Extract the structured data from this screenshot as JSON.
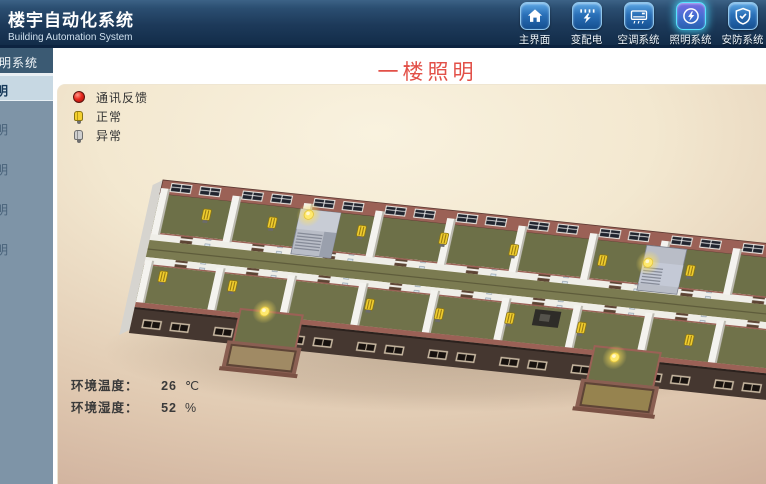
{
  "header": {
    "title": "楼宇自动化系统",
    "subtitle": "Building Automation System",
    "nav": [
      {
        "label": "主界面",
        "icon": "home-icon",
        "active": false
      },
      {
        "label": "变配电",
        "icon": "power-icon",
        "active": false
      },
      {
        "label": "空调系统",
        "icon": "hvac-icon",
        "active": false
      },
      {
        "label": "照明系统",
        "icon": "lighting-icon",
        "active": true
      },
      {
        "label": "安防系统",
        "icon": "shield-icon",
        "active": false
      }
    ]
  },
  "sidebar": {
    "header": "照明系统",
    "items": [
      {
        "label": "一楼照明",
        "active": true
      },
      {
        "label": "二楼照明",
        "active": false
      },
      {
        "label": "三楼照明",
        "active": false
      },
      {
        "label": "四楼照明",
        "active": false
      },
      {
        "label": "五楼照明",
        "active": false
      }
    ]
  },
  "page": {
    "title": "一楼照明"
  },
  "legend": [
    {
      "label": "通讯反馈",
      "icon": "comm-indicator"
    },
    {
      "label": "正常",
      "icon": "bulb-normal"
    },
    {
      "label": "异常",
      "icon": "bulb-abnormal"
    }
  ],
  "stats": [
    {
      "label": "环境温度：",
      "value": "26",
      "unit": "℃"
    },
    {
      "label": "环境湿度：",
      "value": "52",
      "unit": "%"
    }
  ],
  "floorplan": {
    "bulbs_top": [
      [
        50,
        30
      ],
      [
        116,
        31
      ],
      [
        205,
        30
      ],
      [
        287,
        29
      ],
      [
        358,
        33
      ],
      [
        447,
        34
      ],
      [
        535,
        35
      ]
    ],
    "bulbs_bottom": [
      [
        21,
        95
      ],
      [
        91,
        97
      ],
      [
        229,
        101
      ],
      [
        299,
        103
      ],
      [
        369,
        100
      ],
      [
        441,
        102
      ],
      [
        549,
        103
      ]
    ],
    "glows": [
      [
        150,
        19
      ],
      [
        128,
        118
      ],
      [
        492,
        31
      ],
      [
        480,
        127
      ]
    ],
    "colors": {
      "floor": "#6d7048",
      "corridor": "#7b7b51",
      "brick": "#9b6156",
      "facade": "#453730",
      "bulb": "#f0cd2f",
      "glow": "#ffe96e"
    }
  }
}
